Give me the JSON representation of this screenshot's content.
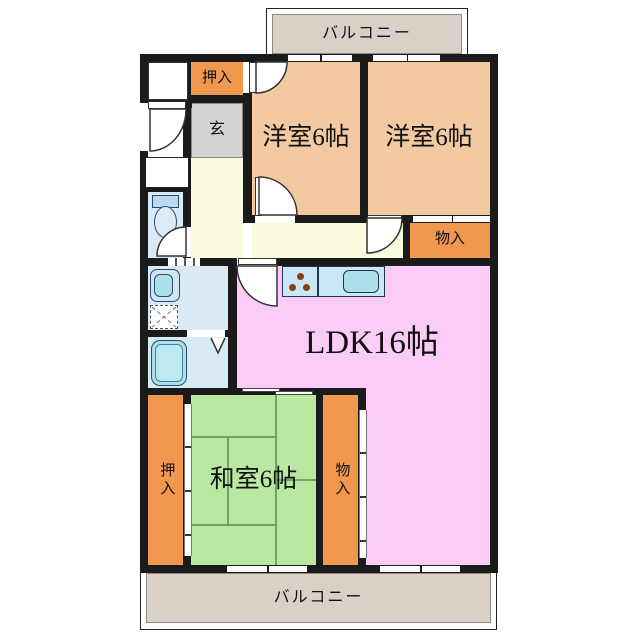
{
  "labels": {
    "balcony_top": "バルコニー",
    "balcony_bottom": "バルコニー",
    "closet_top": "押入",
    "entrance": "玄",
    "western_room_left": "洋室6帖",
    "western_room_right": "洋室6帖",
    "storage_top": "物入",
    "ldk": "LDK16帖",
    "japanese_room": "和室6帖",
    "closet_bottom": "押入",
    "storage_bottom": "物入"
  },
  "colors": {
    "wall": "#1b1b1b",
    "western_room": "#f2c9a1",
    "ldk": "#fbccf7",
    "tatami_room": "#bae8a2",
    "closet": "#f0984e",
    "hallway": "#fafade",
    "entrance_floor": "#d3d3d3",
    "balcony": "#d9d1c8",
    "water_room": "#d8eaf6",
    "fixture_cyan": "#a9e0ec",
    "kitchen_counter": "#c9e7f7",
    "tatami_line": "#6fa55e",
    "burner": "#8a3d12"
  }
}
